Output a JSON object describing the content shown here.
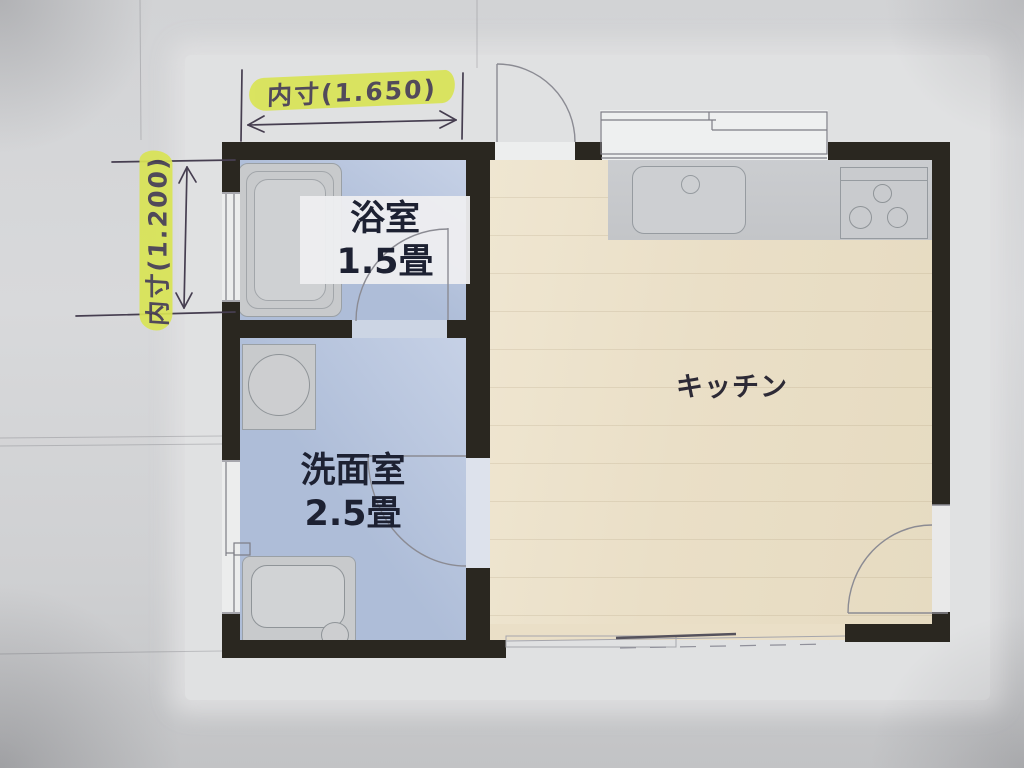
{
  "annotations": {
    "top_dimension": {
      "label": "内寸(1.650)",
      "icon": "dimension-arrow-horizontal-icon",
      "highlighted": true
    },
    "left_dimension": {
      "label": "内寸(1.200)",
      "icon": "dimension-arrow-vertical-icon",
      "highlighted": true,
      "orientation": "rotated-90"
    }
  },
  "rooms": {
    "bathroom": {
      "name": "浴室",
      "size": "1.5畳",
      "fixtures": [
        "bathtub-icon",
        "window-icon",
        "door-swing-icon"
      ]
    },
    "washroom": {
      "name": "洗面室",
      "size": "2.5畳",
      "fixtures": [
        "washing-machine-icon",
        "vanity-sink-icon",
        "sliding-door-icon",
        "door-swing-icon"
      ]
    },
    "kitchen": {
      "name": "キッチン",
      "fixtures": [
        "kitchen-sink-icon",
        "faucet-icon",
        "stove-burners-icon",
        "sliding-window-icon",
        "entry-door-swing-icon",
        "door-swing-icon"
      ]
    }
  },
  "colors": {
    "wall": "#2a2720",
    "room_blue": "#aebdd8",
    "room_blue_light": "#c6d1e6",
    "kitchen_beige": "#eadfc7",
    "counter_gray": "#c7c9cc",
    "fixture_gray": "#c8cacc",
    "highlight_yellow": "#d9e455",
    "ink": "#463e50",
    "label_text": "#1d2132",
    "paper": "#d5d6d8",
    "line": "#85858d"
  }
}
